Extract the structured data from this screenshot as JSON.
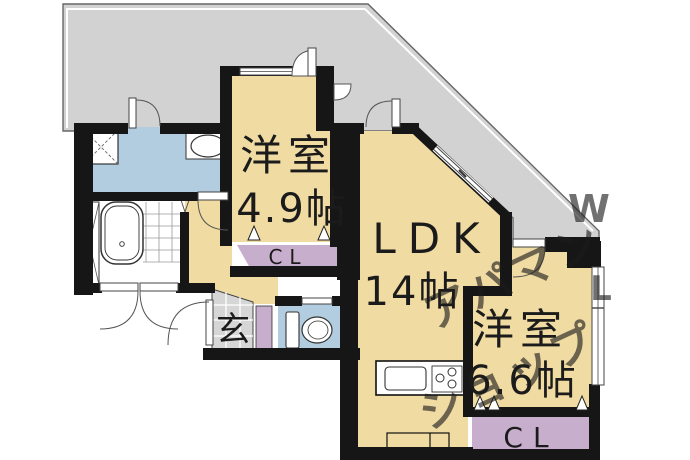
{
  "plan": {
    "type": "apartment-floorplan",
    "labels": {
      "room1_name": "洋室",
      "room1_size": "4.9帖",
      "ldk_name": "LDK",
      "ldk_size": "14帖",
      "room2_name": "洋室",
      "room2_size": "6.6帖",
      "closet1": "CL",
      "closet2": "CL",
      "entrance": "玄"
    },
    "colors": {
      "room": "#f0dba2",
      "balcony": "#d2d2d2",
      "water": "#b2cde0",
      "closet": "#c8aecd",
      "genkan": "#d6d6d6",
      "wall": "#161616",
      "watermark": "#d8bf8e",
      "watermark_gray": "#ccd2c6"
    },
    "watermark": {
      "line1": "アパマン",
      "line2": "ショップ",
      "letter_w": "W",
      "letter_l": "L"
    }
  }
}
